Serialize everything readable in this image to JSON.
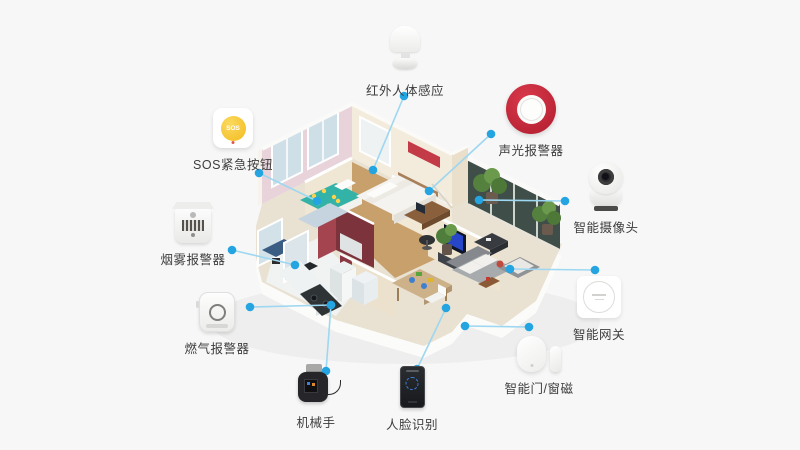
{
  "canvas": {
    "width": 800,
    "height": 450,
    "background": "#f7f7f7"
  },
  "diagram": {
    "kind": "smart-home-security-device-map",
    "house": {
      "style": "isometric-cutaway-apartment",
      "rooms": [
        "bedroom-left",
        "master-bedroom",
        "bathroom",
        "study",
        "living-room",
        "balcony",
        "dining-room",
        "kitchen"
      ]
    },
    "colors": {
      "connector_line": "#9ed7f1",
      "connector_dot": "#24a4e1",
      "label_text": "#3d3d3d",
      "siren_red": "#bf2034",
      "sos_yellow": "#f2bb20",
      "tv_screen": "#2746c8"
    },
    "devices": [
      {
        "id": "motion-sensor",
        "label": "红外人体感应",
        "icon": "pir-motion-sensor",
        "line": {
          "x1": 404,
          "y1": 96,
          "x2": 373,
          "y2": 170
        }
      },
      {
        "id": "sos-button",
        "label": "SOS紧急按钮",
        "icon": "sos-button",
        "icon_text": "SOS",
        "line": {
          "x1": 259,
          "y1": 173,
          "x2": 317,
          "y2": 201
        }
      },
      {
        "id": "smoke-alarm",
        "label": "烟雾报警器",
        "icon": "smoke-detector",
        "line": {
          "x1": 232,
          "y1": 250,
          "x2": 295,
          "y2": 265
        }
      },
      {
        "id": "gas-alarm",
        "label": "燃气报警器",
        "icon": "gas-detector",
        "line": {
          "x1": 250,
          "y1": 307,
          "x2": 331,
          "y2": 305
        }
      },
      {
        "id": "robot-arm",
        "label": "机械手",
        "icon": "mechanical-arm",
        "line": {
          "x1": 326,
          "y1": 371,
          "x2": 331,
          "y2": 305
        }
      },
      {
        "id": "face-recognition",
        "label": "人脸识别",
        "icon": "face-id-terminal",
        "line": {
          "x1": 417,
          "y1": 369,
          "x2": 446,
          "y2": 308
        }
      },
      {
        "id": "door-window-sensor",
        "label": "智能门/窗磁",
        "icon": "door-magnet-pair",
        "line": {
          "x1": 529,
          "y1": 327,
          "x2": 465,
          "y2": 326
        }
      },
      {
        "id": "gateway",
        "label": "智能网关",
        "icon": "gateway-hub",
        "line": {
          "x1": 595,
          "y1": 270,
          "x2": 510,
          "y2": 269
        }
      },
      {
        "id": "camera",
        "label": "智能摄像头",
        "icon": "ptz-camera",
        "line": {
          "x1": 565,
          "y1": 201,
          "x2": 479,
          "y2": 200
        }
      },
      {
        "id": "siren",
        "label": "声光报警器",
        "icon": "strobe-siren",
        "line": {
          "x1": 491,
          "y1": 134,
          "x2": 429,
          "y2": 191
        }
      }
    ]
  }
}
